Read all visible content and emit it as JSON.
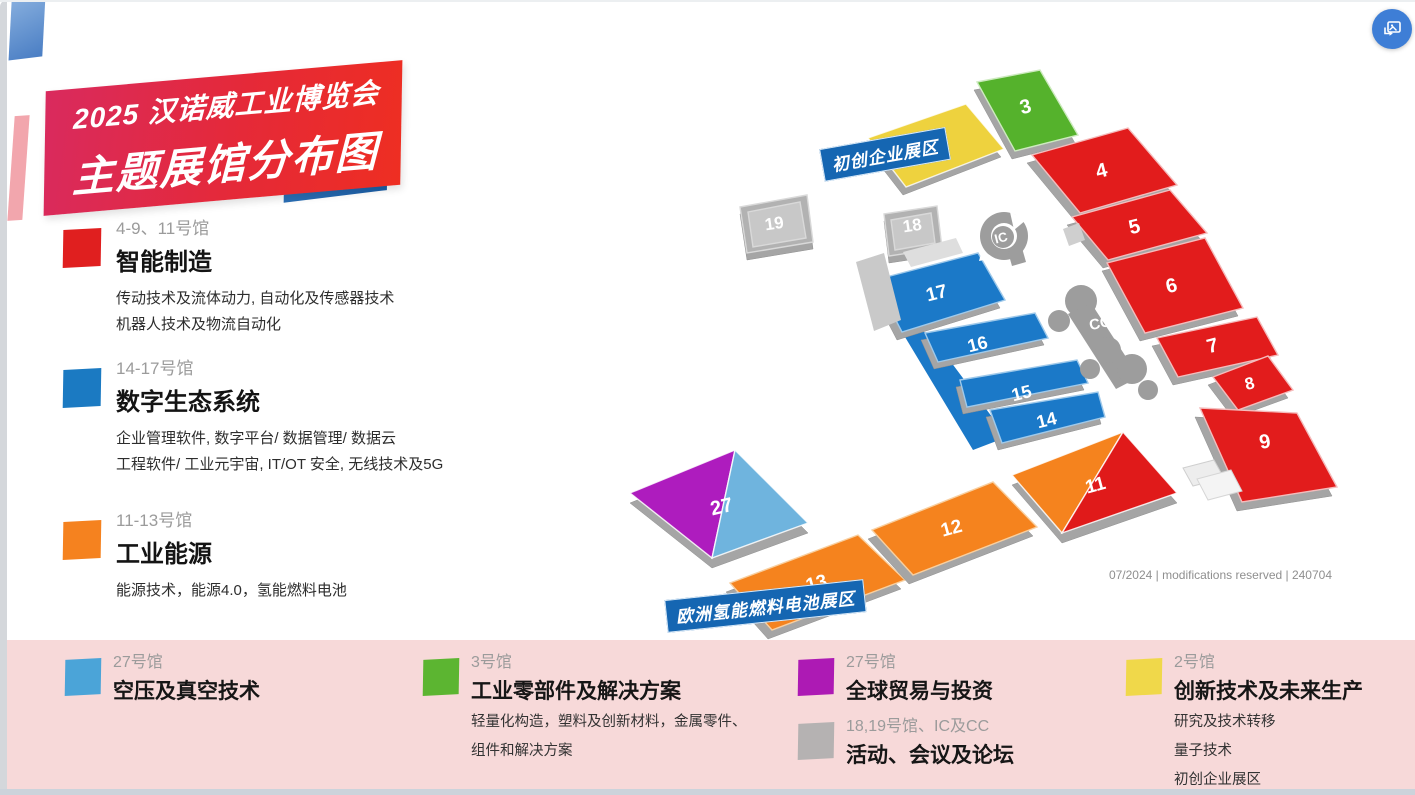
{
  "header": {
    "line1": "2025 汉诺威工业博览会",
    "line2": "主题展馆分布图"
  },
  "watermark": "07/2024 | modifications reserved | 240704",
  "legend_left": [
    {
      "hall": "4-9、11号馆",
      "title": "智能制造",
      "color": "#e01f1f",
      "lines": [
        "传动技术及流体动力, 自动化及传感器技术",
        "机器人技术及物流自动化"
      ]
    },
    {
      "hall": "14-17号馆",
      "title": "数字生态系统",
      "color": "#1b7ac2",
      "lines": [
        "企业管理软件, 数字平台/ 数据管理/ 数据云",
        "工程软件/ 工业元宇宙, IT/OT 安全, 无线技术及5G"
      ]
    },
    {
      "hall": "11-13号馆",
      "title": "工业能源",
      "color": "#f5821f",
      "lines": [
        "能源技术，能源4.0，氢能燃料电池"
      ]
    }
  ],
  "legend_bottom": [
    {
      "hall": "27号馆",
      "title": "空压及真空技术",
      "color": "#4ba4d8",
      "lines": []
    },
    {
      "hall": "3号馆",
      "title": "工业零部件及解决方案",
      "color": "#5cb531",
      "lines": [
        "轻量化构造，塑料及创新材料，金属零件、",
        "组件和解决方案"
      ]
    },
    {
      "hall": "27号馆",
      "title": "全球贸易与投资",
      "color": "#ad1ab4",
      "lines": []
    },
    {
      "hall": "18,19号馆、IC及CC",
      "title": "活动、会议及论坛",
      "color": "#b5b2b2",
      "lines": []
    },
    {
      "hall": "2号馆",
      "title": "创新技术及未来生产",
      "color": "#f0d84a",
      "lines": [
        "研究及技术转移",
        "量子技术",
        "初创企业展区"
      ]
    }
  ],
  "map": {
    "zone_labels": [
      {
        "id": "startup-zone",
        "text": "初创企业展区",
        "x": 822,
        "y": 149,
        "rot": -10
      },
      {
        "id": "hydrogen-zone",
        "text": "欧洲氢能燃料电池展区",
        "x": 666,
        "y": 600,
        "rot": -6
      }
    ],
    "halls": [
      {
        "id": "19",
        "outline": [
          [
            740,
            207
          ],
          [
            807,
            195
          ],
          [
            813,
            242
          ],
          [
            747,
            253
          ]
        ],
        "base": [
          0,
          7
        ],
        "parts": [
          {
            "fill": "#b2b2b2"
          },
          {
            "fill": "#c8c8c8",
            "pts": [
              [
                748,
                212
              ],
              [
                800,
                202
              ],
              [
                806,
                238
              ],
              [
                753,
                247
              ]
            ]
          }
        ],
        "stroke": "#d9d9d9",
        "label": {
          "text": "19",
          "x": 775,
          "y": 229,
          "rot": -8,
          "size": 17
        }
      },
      {
        "id": "18",
        "outline": [
          [
            884,
            214
          ],
          [
            937,
            206
          ],
          [
            942,
            248
          ],
          [
            889,
            256
          ]
        ],
        "base": [
          0,
          7
        ],
        "parts": [
          {
            "fill": "#b2b2b2"
          },
          {
            "fill": "#c8c8c8",
            "pts": [
              [
                891,
                220
              ],
              [
                931,
                213
              ],
              [
                935,
                243
              ],
              [
                895,
                250
              ]
            ]
          }
        ],
        "stroke": "#d9d9d9",
        "label": {
          "text": "18",
          "x": 913,
          "y": 231,
          "rot": -8,
          "size": 17
        }
      },
      {
        "id": "2",
        "outline": [
          [
            868,
            138
          ],
          [
            966,
            104
          ],
          [
            1004,
            149
          ],
          [
            906,
            187
          ]
        ],
        "base": [
          -3,
          8
        ],
        "parts": [
          {
            "fill": "#eed23e"
          }
        ],
        "stroke": "rgba(255,255,255,0.8)",
        "label": {
          "text": "2",
          "x": 938,
          "y": 149,
          "rot": -15,
          "size": 20
        }
      },
      {
        "id": "3",
        "outline": [
          [
            977,
            82
          ],
          [
            1040,
            70
          ],
          [
            1078,
            135
          ],
          [
            1015,
            151
          ]
        ],
        "base": [
          -3,
          8
        ],
        "parts": [
          {
            "fill": "#55b22c"
          }
        ],
        "stroke": "#cdeabf",
        "label": {
          "text": "3",
          "x": 1027,
          "y": 113,
          "rot": -14,
          "size": 20
        }
      },
      {
        "id": "4",
        "outline": [
          [
            1032,
            155
          ],
          [
            1128,
            128
          ],
          [
            1177,
            185
          ],
          [
            1080,
            213
          ]
        ],
        "base": [
          -5,
          8
        ],
        "parts": [
          {
            "fill": "#e21c1c"
          }
        ],
        "stroke": "#f4bcbc",
        "label": {
          "text": "4",
          "x": 1103,
          "y": 177,
          "rot": -14,
          "size": 20
        }
      },
      {
        "id": "5",
        "outline": [
          [
            1072,
            217
          ],
          [
            1170,
            190
          ],
          [
            1207,
            233
          ],
          [
            1108,
            260
          ]
        ],
        "base": [
          -5,
          8
        ],
        "parts": [
          {
            "fill": "#e21c1c"
          }
        ],
        "stroke": "#f4bcbc",
        "label": {
          "text": "5",
          "x": 1136,
          "y": 233,
          "rot": -14,
          "size": 20
        }
      },
      {
        "id": "17-spine",
        "outline": [
          [
            896,
            322
          ],
          [
            930,
            334
          ],
          [
            1007,
            437
          ],
          [
            973,
            450
          ]
        ],
        "base": null,
        "parts": [
          {
            "fill": "#1b79c8"
          }
        ],
        "stroke": "none",
        "label": null
      },
      {
        "id": "17",
        "outline": [
          [
            875,
            280
          ],
          [
            978,
            253
          ],
          [
            1005,
            300
          ],
          [
            902,
            332
          ]
        ],
        "base": [
          -5,
          8
        ],
        "parts": [
          {
            "fill": "#1b79c8"
          }
        ],
        "stroke": "#9fc9ea",
        "label": {
          "text": "17",
          "x": 938,
          "y": 299,
          "rot": -14,
          "size": 19
        }
      },
      {
        "id": "16",
        "outline": [
          [
            925,
            333
          ],
          [
            1035,
            313
          ],
          [
            1048,
            338
          ],
          [
            938,
            362
          ]
        ],
        "base": [
          -4,
          7
        ],
        "parts": [
          {
            "fill": "#1b79c8"
          }
        ],
        "stroke": "#9fc9ea",
        "label": {
          "text": "16",
          "x": 979,
          "y": 350,
          "rot": -14,
          "size": 18
        }
      },
      {
        "id": "15",
        "outline": [
          [
            960,
            380
          ],
          [
            1077,
            360
          ],
          [
            1088,
            383
          ],
          [
            967,
            407
          ]
        ],
        "base": [
          -4,
          7
        ],
        "parts": [
          {
            "fill": "#1b79c8"
          }
        ],
        "stroke": "#9fc9ea",
        "label": {
          "text": "15",
          "x": 1023,
          "y": 399,
          "rot": -14,
          "size": 18
        }
      },
      {
        "id": "14",
        "outline": [
          [
            990,
            410
          ],
          [
            1098,
            392
          ],
          [
            1105,
            417
          ],
          [
            1002,
            443
          ]
        ],
        "base": [
          -4,
          7
        ],
        "parts": [
          {
            "fill": "#1b79c8"
          }
        ],
        "stroke": "#9fc9ea",
        "label": {
          "text": "14",
          "x": 1048,
          "y": 426,
          "rot": -14,
          "size": 18
        }
      },
      {
        "id": "6",
        "outline": [
          [
            1107,
            263
          ],
          [
            1205,
            238
          ],
          [
            1243,
            308
          ],
          [
            1145,
            333
          ]
        ],
        "base": [
          -5,
          8
        ],
        "parts": [
          {
            "fill": "#e21c1c"
          }
        ],
        "stroke": "#f4bcbc",
        "label": {
          "text": "6",
          "x": 1173,
          "y": 292,
          "rot": -14,
          "size": 20
        }
      },
      {
        "id": "7",
        "outline": [
          [
            1157,
            338
          ],
          [
            1257,
            317
          ],
          [
            1278,
            355
          ],
          [
            1178,
            377
          ]
        ],
        "base": [
          -5,
          8
        ],
        "parts": [
          {
            "fill": "#e21c1c"
          }
        ],
        "stroke": "#f4bcbc",
        "label": {
          "text": "7",
          "x": 1214,
          "y": 352,
          "rot": -14,
          "size": 20
        }
      },
      {
        "id": "8",
        "outline": [
          [
            1213,
            377
          ],
          [
            1268,
            356
          ],
          [
            1293,
            390
          ],
          [
            1238,
            410
          ]
        ],
        "base": [
          -5,
          8
        ],
        "parts": [
          {
            "fill": "#e21c1c"
          }
        ],
        "stroke": "#f4bcbc",
        "label": {
          "text": "8",
          "x": 1251,
          "y": 389,
          "rot": -14,
          "size": 17
        }
      },
      {
        "id": "9",
        "outline": [
          [
            1200,
            408
          ],
          [
            1297,
            413
          ],
          [
            1337,
            487
          ],
          [
            1242,
            502
          ]
        ],
        "base": [
          -5,
          9
        ],
        "parts": [
          {
            "fill": "#e21c1c"
          }
        ],
        "stroke": "#f4bcbc",
        "label": {
          "text": "9",
          "x": 1266,
          "y": 448,
          "rot": -10,
          "size": 20
        }
      },
      {
        "id": "27",
        "outline": [
          [
            735,
            450
          ],
          [
            808,
            523
          ],
          [
            712,
            558
          ],
          [
            630,
            493
          ]
        ],
        "base": [
          0,
          10
        ],
        "parts": [
          {
            "fill": "#ae1cbe",
            "pts": [
              [
                735,
                450
              ],
              [
                630,
                493
              ],
              [
                712,
                558
              ]
            ]
          },
          {
            "fill": "#6fb4de",
            "pts": [
              [
                735,
                450
              ],
              [
                808,
                523
              ],
              [
                712,
                558
              ]
            ]
          }
        ],
        "stroke": "rgba(255,255,255,0.85)",
        "label": {
          "text": "27",
          "x": 723,
          "y": 513,
          "rot": -13,
          "size": 20
        }
      },
      {
        "id": "13",
        "outline": [
          [
            730,
            583
          ],
          [
            858,
            535
          ],
          [
            905,
            580
          ],
          [
            772,
            630
          ]
        ],
        "base": [
          -4,
          9
        ],
        "parts": [
          {
            "fill": "#f5831e"
          }
        ],
        "stroke": "#f8cf9f",
        "label": {
          "text": "13",
          "x": 818,
          "y": 589,
          "rot": -15,
          "size": 19
        }
      },
      {
        "id": "12",
        "outline": [
          [
            872,
            530
          ],
          [
            993,
            482
          ],
          [
            1037,
            527
          ],
          [
            913,
            575
          ]
        ],
        "base": [
          -4,
          9
        ],
        "parts": [
          {
            "fill": "#f5831e"
          }
        ],
        "stroke": "#f8cf9f",
        "label": {
          "text": "12",
          "x": 953,
          "y": 534,
          "rot": -15,
          "size": 19
        }
      },
      {
        "id": "11",
        "outline": [
          [
            1123,
            432
          ],
          [
            1177,
            493
          ],
          [
            1062,
            533
          ],
          [
            1012,
            475
          ]
        ],
        "base": [
          0,
          10
        ],
        "parts": [
          {
            "fill": "#f5831e",
            "pts": [
              [
                1012,
                475
              ],
              [
                1123,
                432
              ],
              [
                1062,
                533
              ]
            ]
          },
          {
            "fill": "#e01a1a",
            "pts": [
              [
                1123,
                432
              ],
              [
                1177,
                493
              ],
              [
                1062,
                533
              ]
            ]
          }
        ],
        "stroke": "rgba(255,255,255,0.85)",
        "label": {
          "text": "11",
          "x": 1097,
          "y": 491,
          "rot": -15,
          "size": 19
        }
      }
    ],
    "extras": [
      {
        "type": "poly",
        "pts": [
          [
            856,
            262
          ],
          [
            884,
            253
          ],
          [
            901,
            320
          ],
          [
            874,
            331
          ]
        ],
        "fill": "#c9c9c9"
      },
      {
        "type": "poly",
        "pts": [
          [
            903,
            252
          ],
          [
            956,
            238
          ],
          [
            963,
            253
          ],
          [
            911,
            267
          ]
        ],
        "fill": "#dedede"
      },
      {
        "type": "poly",
        "pts": [
          [
            1063,
            229
          ],
          [
            1079,
            223
          ],
          [
            1085,
            240
          ],
          [
            1069,
            246
          ]
        ],
        "fill": "#cfcfcf"
      },
      {
        "type": "poly",
        "pts": [
          [
            1183,
            468
          ],
          [
            1214,
            460
          ],
          [
            1224,
            478
          ],
          [
            1193,
            486
          ]
        ],
        "fill": "#ededed",
        "stroke": "#cfcfcf"
      },
      {
        "type": "poly",
        "pts": [
          [
            1197,
            479
          ],
          [
            1231,
            470
          ],
          [
            1242,
            491
          ],
          [
            1208,
            500
          ]
        ],
        "fill": "#f4f4f4",
        "stroke": "#d6d6d6"
      },
      {
        "type": "circle",
        "cx": 1004,
        "cy": 236,
        "r": 24,
        "fill": "#9d9d9d"
      },
      {
        "type": "circle",
        "cx": 1004,
        "cy": 236,
        "r": 13,
        "fill": "#ffffff"
      },
      {
        "type": "poly",
        "pts": [
          [
            1010,
            212
          ],
          [
            1026,
            220
          ],
          [
            1014,
            230
          ]
        ],
        "fill": "#ffffff"
      },
      {
        "type": "poly",
        "pts": [
          [
            982,
            250
          ],
          [
            994,
            258
          ],
          [
            979,
            261
          ]
        ],
        "fill": "#ffffff"
      },
      {
        "type": "circle",
        "cx": 1003,
        "cy": 237,
        "r": 11,
        "fill": "#9d9d9d"
      },
      {
        "type": "poly",
        "pts": [
          [
            1008,
            252
          ],
          [
            1022,
            248
          ],
          [
            1026,
            262
          ],
          [
            1012,
            266
          ]
        ],
        "fill": "#9d9d9d"
      },
      {
        "type": "text",
        "text": "IC",
        "x": 1002,
        "y": 242,
        "rot": -14,
        "size": 13
      },
      {
        "type": "circle",
        "cx": 1081,
        "cy": 301,
        "r": 16,
        "fill": "#9d9d9d"
      },
      {
        "type": "circle",
        "cx": 1059,
        "cy": 321,
        "r": 11,
        "fill": "#9d9d9d"
      },
      {
        "type": "poly",
        "pts": [
          [
            1068,
            314
          ],
          [
            1091,
            303
          ],
          [
            1139,
            377
          ],
          [
            1116,
            389
          ]
        ],
        "fill": "#9d9d9d"
      },
      {
        "type": "circle",
        "cx": 1108,
        "cy": 350,
        "r": 13,
        "fill": "#9d9d9d"
      },
      {
        "type": "circle",
        "cx": 1090,
        "cy": 369,
        "r": 10,
        "fill": "#9d9d9d"
      },
      {
        "type": "circle",
        "cx": 1132,
        "cy": 369,
        "r": 15,
        "fill": "#9d9d9d"
      },
      {
        "type": "circle",
        "cx": 1148,
        "cy": 390,
        "r": 10,
        "fill": "#9d9d9d"
      },
      {
        "type": "text",
        "text": "CC",
        "x": 1101,
        "y": 328,
        "rot": -12,
        "size": 15
      }
    ]
  },
  "icons": {
    "floating_button": "open-image-preview-icon"
  },
  "colors": {
    "accent_red": "#e21c1c",
    "accent_blue": "#1b79c8",
    "accent_orange": "#f5831e",
    "accent_green": "#55b22c",
    "accent_purple": "#ae1cbe",
    "accent_lightblue": "#6fb4de",
    "accent_yellow": "#eed23e",
    "accent_gray": "#b2b2b2",
    "zone_label_bg": "#1566b2",
    "bottom_strip_bg": "#f7d9d9"
  }
}
